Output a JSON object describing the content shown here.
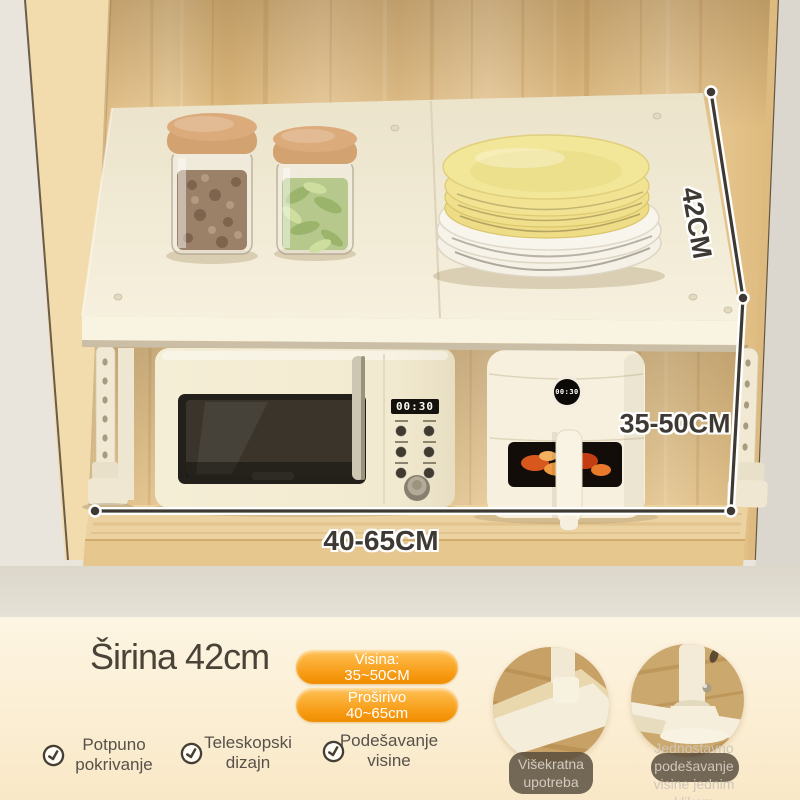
{
  "photo": {
    "dimension_depth": "42CM",
    "dimension_height": "35-50CM",
    "dimension_width": "40-65CM",
    "microwave_display": "00:30",
    "airfryer_display": "00:30"
  },
  "info": {
    "title": "Širina 42cm",
    "badges": [
      {
        "line1": "Visina:",
        "line2": "35~50CM"
      },
      {
        "line1": "Proširivo",
        "line2": "40~65cm"
      }
    ],
    "features": [
      {
        "line1": "Potpuno",
        "line2": "pokrivanje"
      },
      {
        "line1": "Teleskopski",
        "line2": "dizajn"
      },
      {
        "line1": "Podešavanje",
        "line2": "visine"
      }
    ],
    "details": [
      {
        "line1": "Višekratna",
        "line2": "upotreba"
      },
      {
        "line1": "Jednostavno",
        "line2": "podešavanje",
        "line3": "visine jednim",
        "line4": "klikom"
      }
    ]
  },
  "colors": {
    "accent_orange": "#f79b13",
    "badge_text": "#ffffff",
    "title_text": "#4a4337",
    "dimension_text": "#3e3933",
    "caption_text": "#d3cbbf",
    "wood": "#e6c48c",
    "shelf_cream": "#f4edda"
  }
}
